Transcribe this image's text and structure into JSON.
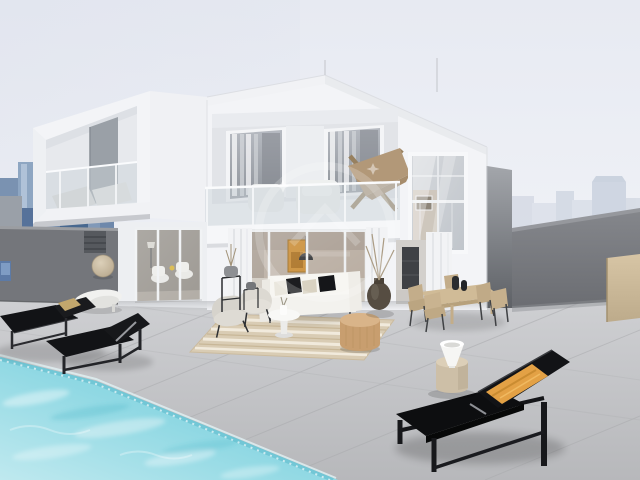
{
  "scene": {
    "type": "3d-architectural-rendering",
    "description": "Modern two-storey white villa with cantilevered balcony box, recessed upper terrace, glass balustrades, ground-floor sliding glass doors, large tiled roof-deck with outdoor lounge and dining furniture, turquoise swimming pool at lower left, black sun loungers, hazy city skyline in background",
    "watermark": "faint circular real-estate logo with house glyph and sparkle decals, centered"
  },
  "colors": {
    "sky_top": "#e7eaf2",
    "sky_bottom": "#f7f8fa",
    "skyline_blue": "#6d87a9",
    "skyline_blue_light": "#8ea6c2",
    "skyline_blue_dark": "#4f6d94",
    "skyline_haze": "#d4dae4",
    "house_white": "#f3f4f7",
    "house_shade": "#e6e8ec",
    "recess_wall": "#e2e4e8",
    "glass_tint": "#ccd4da",
    "curtain_white": "#f2f3f5",
    "wall_dark_left": "#74767b",
    "wall_dark_right": "#77797e",
    "slab_gray_top": "#a3a6ab",
    "slab_gray_bottom": "#5e6166",
    "deck_tile_top": "#d0d1d4",
    "deck_tile_bottom": "#b7b8bb",
    "grout": "#aaabae",
    "pool_light": "#bfe9ef",
    "pool_mid": "#8fd8e3",
    "pool_deep": "#6ecbdb",
    "lounger_black": "#121316",
    "pillow_orange": "#e3a145",
    "pillow_tan": "#c2a76d",
    "rug_beige": "#d9ccb4",
    "rug_stripe": "#f4eee1",
    "sofa_white": "#f3f2ee",
    "armchair_gray": "#d6d3cc",
    "pouf_rattan": "#c89e6f",
    "dining_wood": "#d0bb97",
    "chair_tan": "#c3ad8a",
    "art_amber": "#c98c34",
    "interior_beige": "#b8aca0",
    "vase_white": "#f6f6f4",
    "stool_beige": "#cdbfa7",
    "disc_tan": "#c9b89d",
    "urn_bronze": "#564d42",
    "plaque_blue": "#5c7aa6",
    "tan_panel": "#cdbb9b",
    "watermark_white": "#ffffff"
  },
  "objects": [
    {
      "name": "villa",
      "note": "two-storey white modern house"
    },
    {
      "name": "balcony-box",
      "note": "cantilevered white frame balcony, upper left"
    },
    {
      "name": "upper-terrace",
      "note": "recessed balcony with glass balustrade, curtains, butterfly chair"
    },
    {
      "name": "bedroom-window",
      "note": "tall window on right volume"
    },
    {
      "name": "sliding-doors",
      "note": "ground floor glass doors with interior views"
    },
    {
      "name": "pool",
      "note": "turquoise swimming pool, lower left"
    },
    {
      "name": "sun-loungers-left",
      "note": "two black loungers by the pool"
    },
    {
      "name": "sun-lounger-right",
      "note": "black lounger with orange pillow"
    },
    {
      "name": "outdoor-sofa-set",
      "note": "white sofa, gray armchairs, rug, pouf, side table"
    },
    {
      "name": "dining-set",
      "note": "wooden table with tan chairs and black vases"
    },
    {
      "name": "city-skyline",
      "note": "blue towers left, hazy towers right"
    },
    {
      "name": "dark-parapet-walls",
      "note": "gray terrace walls left and right"
    }
  ]
}
